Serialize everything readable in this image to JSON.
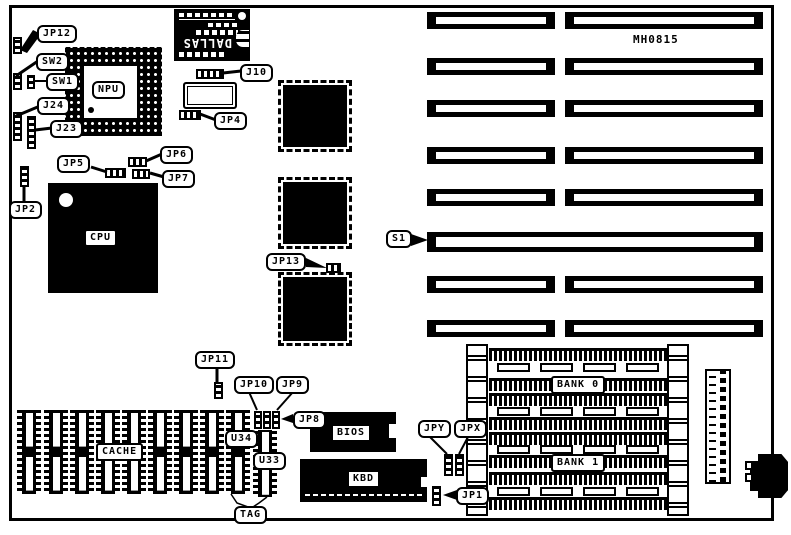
{
  "board": {
    "part_number": "MH0815"
  },
  "callouts": {
    "jp12": "JP12",
    "sw2": "SW2",
    "sw1": "SW1",
    "j24": "J24",
    "j23": "J23",
    "jp2": "JP2",
    "jp5": "JP5",
    "jp6": "JP6",
    "jp7": "JP7",
    "j10": "J10",
    "jp4": "JP4",
    "jp13": "JP13",
    "s1": "S1",
    "jp11": "JP11",
    "jp10": "JP10",
    "jp9": "JP9",
    "jp8": "JP8",
    "jpy": "JPY",
    "jpx": "JPX",
    "jp1": "JP1",
    "tag": "TAG",
    "u34": "U34",
    "u33": "U33"
  },
  "chips": {
    "npu": "NPU",
    "cpu": "CPU",
    "dallas_brand": "DALLAS",
    "bios": "BIOS",
    "kbd": "KBD",
    "cache": "CACHE",
    "bank0": "BANK 0",
    "bank1": "BANK 1"
  },
  "colors": {
    "board_bg": "#ffffff",
    "ink": "#000000"
  }
}
